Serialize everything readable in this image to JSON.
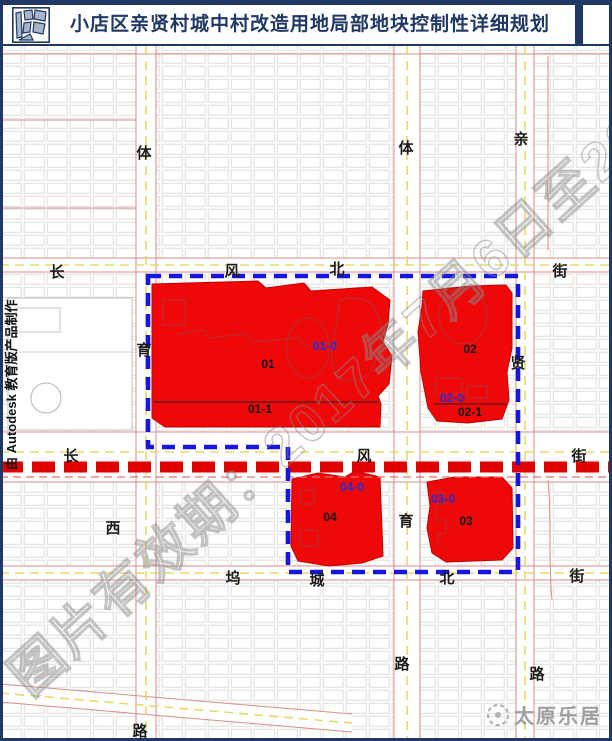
{
  "header": {
    "title": "小店区亲贤村城中村改造用地局部地块控制性详细规划"
  },
  "map": {
    "credit": "由 Autodesk 教育版产品制作",
    "watermark": "图片有效期：2017年7月6日至2017",
    "brand": "太原乐居",
    "streets": [
      "体",
      "育",
      "西",
      "路",
      "体",
      "育",
      "路",
      "亲",
      "贤",
      "路",
      "长",
      "风",
      "北",
      "街",
      "长",
      "风",
      "街",
      "坞",
      "城",
      "北",
      "街"
    ],
    "plot_labels": [
      "01",
      "01-0",
      "01-1",
      "02",
      "02-0",
      "02-1",
      "03",
      "03-0",
      "04",
      "04-0"
    ],
    "colors": {
      "navy": "#1f3864",
      "plot_red": "#ee0808",
      "boundary_blue": "#1616df",
      "axis_red": "#e00000",
      "label_blue": "#2b2bcc"
    }
  }
}
